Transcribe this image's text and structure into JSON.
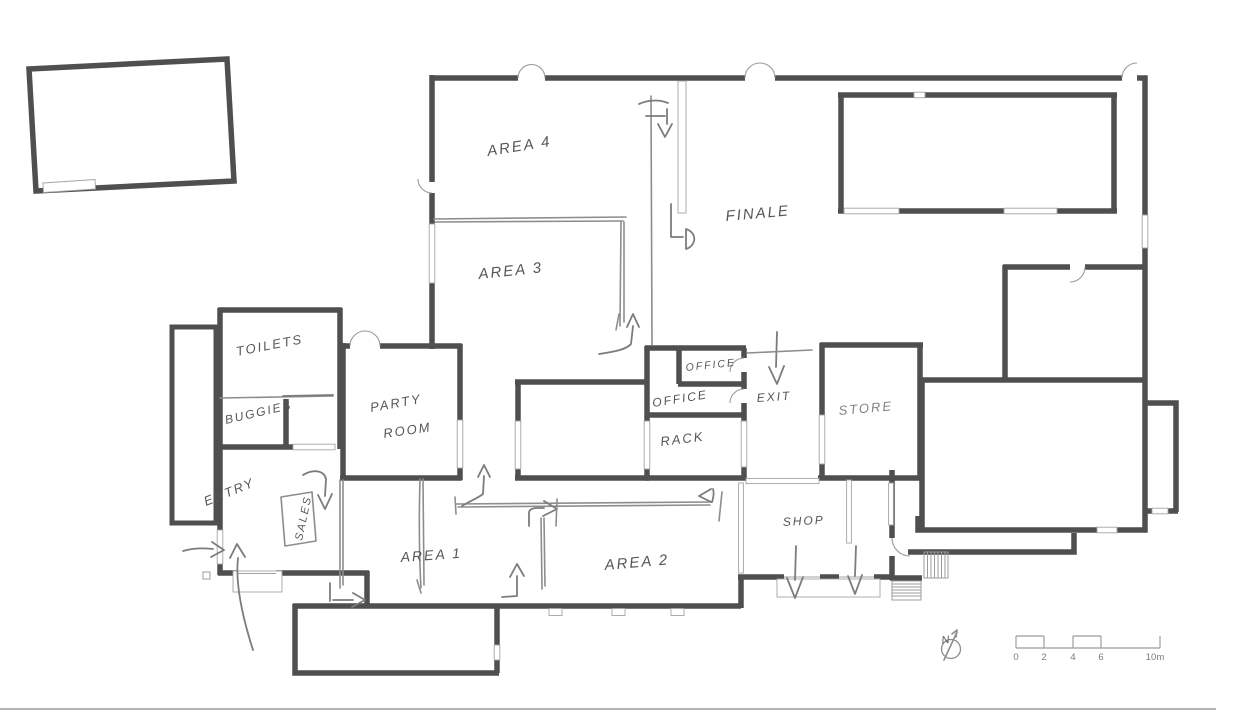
{
  "plan": {
    "title": "hand-sketched floor plan",
    "rooms": {
      "area4": {
        "label": "AREA 4"
      },
      "area3": {
        "label": "AREA 3"
      },
      "finale": {
        "label": "FINALE"
      },
      "toilets": {
        "label": "TOILETS"
      },
      "buggies": {
        "label": "BUGGIES"
      },
      "party_line1": {
        "label": "PARTY"
      },
      "party_line2": {
        "label": "ROOM"
      },
      "entry": {
        "label": "ENTRY"
      },
      "sales": {
        "label": "SALES"
      },
      "area1": {
        "label": "AREA 1"
      },
      "area2": {
        "label": "AREA 2"
      },
      "shop": {
        "label": "SHOP"
      },
      "office_upper": {
        "label": "OFFICE"
      },
      "office_lower": {
        "label": "OFFICE"
      },
      "rack": {
        "label": "RACK"
      },
      "exit": {
        "label": "EXIT"
      },
      "store": {
        "label": "STORE"
      }
    },
    "scale_bar": {
      "labels": [
        "0",
        "2",
        "4",
        "6",
        "10m"
      ]
    },
    "north_arrow": {
      "label": "N"
    },
    "colors": {
      "wall": "#4f4f4f",
      "thin_line": "#a3a3a3",
      "pencil": "#8d8d8d",
      "handwriting": "#565656",
      "background": "#ffffff"
    }
  }
}
